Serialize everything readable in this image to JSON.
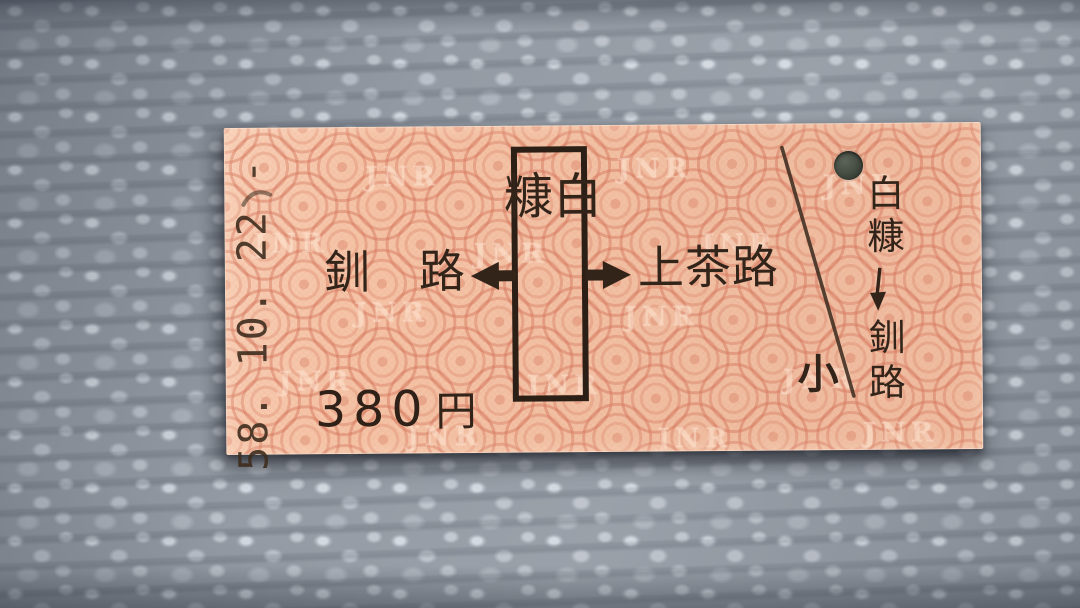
{
  "ticket": {
    "date_stamp": "58. 10. 22 -",
    "left_station": "釧路",
    "boxed_station": "白糠",
    "right_station": "上茶路",
    "fare_amount": "380",
    "fare_unit": "円",
    "child_mark": "小",
    "route_from": "白糠",
    "route_to": "釧路",
    "watermark": "JNR"
  },
  "icons": {
    "left_arrow": "◀",
    "right_arrow": "▶",
    "down_arrow": "↓",
    "punch_hole": "●"
  },
  "colors": {
    "ticket_base": "#f5c3a6",
    "ticket_pattern": "#d4745a",
    "ink": "#33241a",
    "stamp_ink": "#4a372a",
    "carpet": "#949ba4",
    "punch_hole": "#474e44"
  }
}
